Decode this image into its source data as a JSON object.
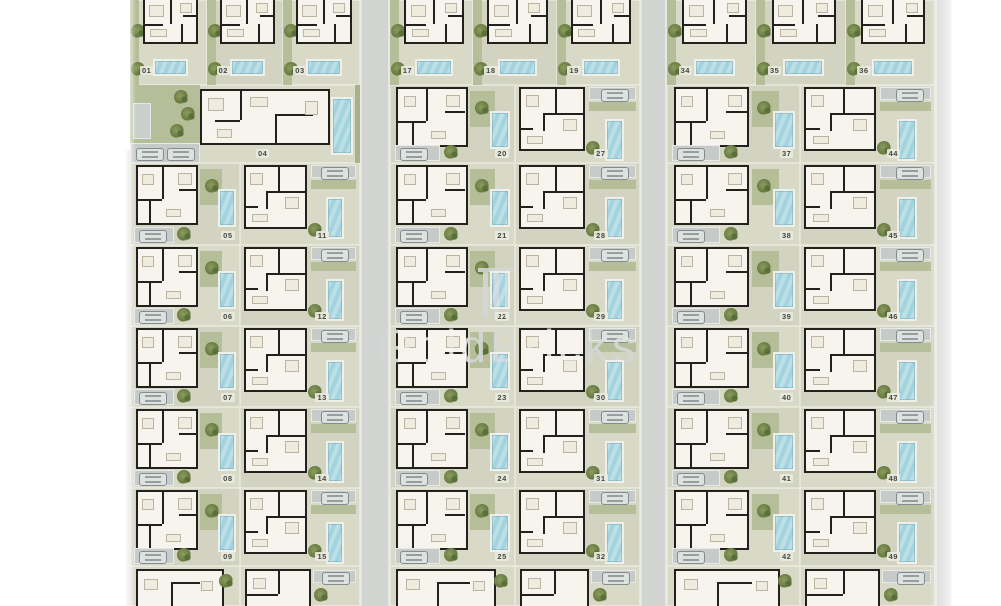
{
  "document": {
    "type": "residential-site-plan",
    "description": "Master plan of numbered villa plots with floor plans, pools, driveways and gardens"
  },
  "watermark": {
    "text": "GoldBricks",
    "logo": "columns-emblem-icon"
  },
  "palette": {
    "plot": "#d8d9c7",
    "street": "#d2d4d2",
    "grass": "#b5bd99",
    "pool": "#b3dae2",
    "wall": "#22211e",
    "floor": "#f6f4ed",
    "driveway": "#c6cac8",
    "tree": "#6f8148",
    "label_text": "#45473e",
    "watermark": "#d3d6d4"
  },
  "layout": {
    "rows_y": [
      0,
      85,
      163,
      245,
      326,
      407,
      488,
      566,
      606
    ]
  },
  "streets": [
    {
      "x": 112,
      "w": 20,
      "y": 150
    },
    {
      "x": 360,
      "w": 30,
      "y": 0
    },
    {
      "x": 640,
      "w": 27,
      "y": 0
    },
    {
      "x": 935,
      "w": 17,
      "y": 0
    }
  ],
  "blocks": [
    {
      "id": "left",
      "x": 130,
      "w": 230,
      "sub": [
        110,
        120
      ],
      "pair_start_row": 2,
      "top_units": [
        "01",
        "02",
        "03"
      ],
      "wide_unit": "04",
      "pairs": [
        [
          "05",
          "11"
        ],
        [
          "06",
          "12"
        ],
        [
          "07",
          "13"
        ],
        [
          "08",
          "14"
        ],
        [
          "09",
          "15"
        ]
      ]
    },
    {
      "id": "middle",
      "x": 390,
      "w": 250,
      "sub": [
        125,
        125
      ],
      "pair_start_row": 1,
      "top_units": [
        "17",
        "18",
        "19"
      ],
      "pairs": [
        [
          "20",
          "27"
        ],
        [
          "21",
          "28"
        ],
        [
          "22",
          "29"
        ],
        [
          "23",
          "30"
        ],
        [
          "24",
          "31"
        ],
        [
          "25",
          "32"
        ]
      ]
    },
    {
      "id": "right",
      "x": 667,
      "w": 268,
      "sub": [
        133,
        135
      ],
      "pair_start_row": 1,
      "top_units": [
        "34",
        "35",
        "36"
      ],
      "pairs": [
        [
          "37",
          "44"
        ],
        [
          "38",
          "45"
        ],
        [
          "39",
          "46"
        ],
        [
          "40",
          "47"
        ],
        [
          "41",
          "48"
        ],
        [
          "42",
          "49"
        ]
      ]
    }
  ]
}
